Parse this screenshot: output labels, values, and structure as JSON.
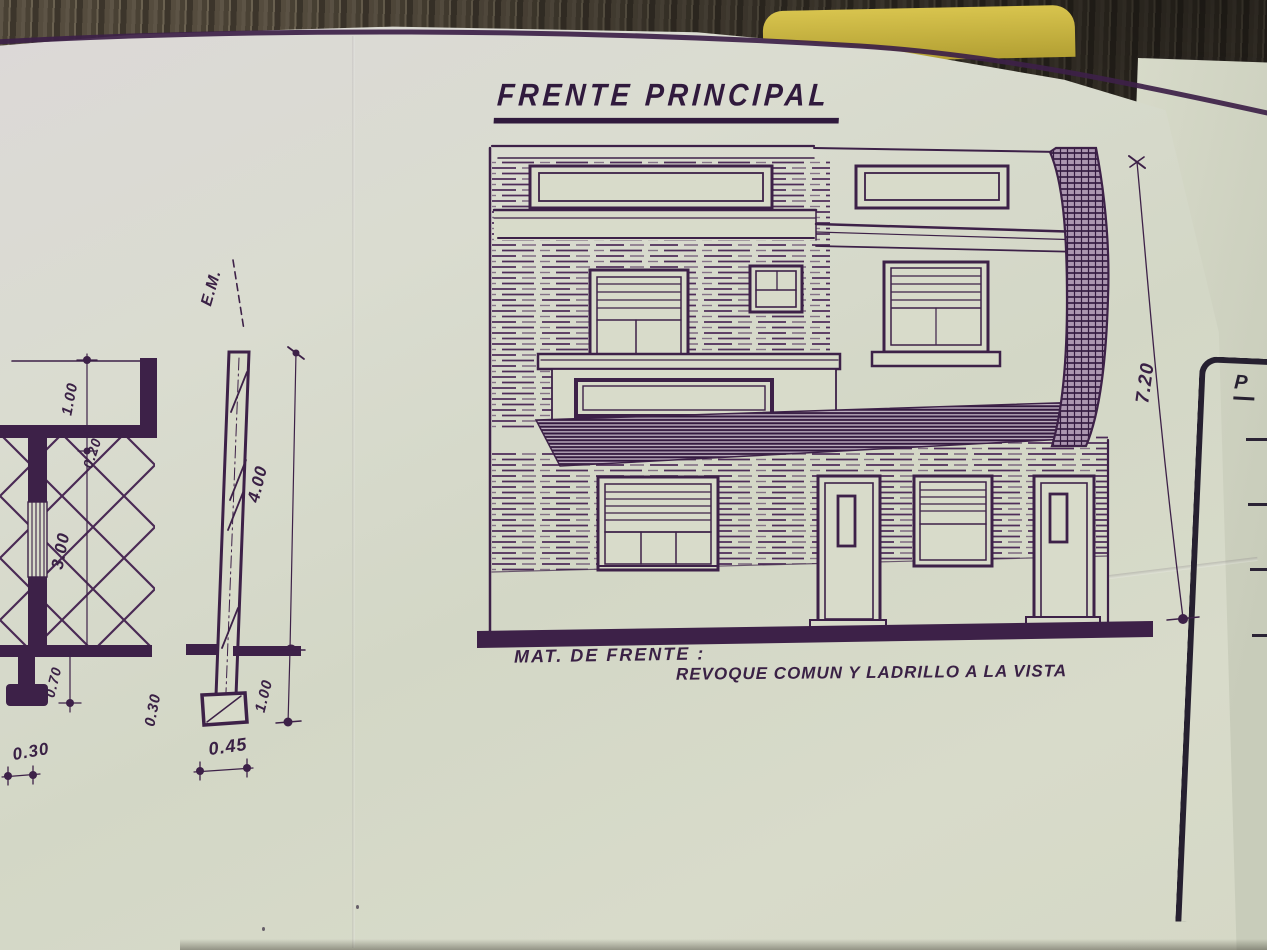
{
  "scene": {
    "description": "Photograph of an architectural blueprint sheet lying on a dark wooden table, second sheet and yellow note partially visible",
    "colors": {
      "ink": "#3d2148",
      "paper": "#d8dbca",
      "paper_right_sheet": "#cdd1bf",
      "wood_dark": "#3c352b",
      "wood_light": "#6a6150",
      "sticky_note": "#c9b540"
    }
  },
  "title": "FRENTE PRINCIPAL",
  "material_note": {
    "label": "MAT. DE FRENTE :",
    "value": "REVOQUE COMUN Y LADRILLO A LA VISTA"
  },
  "dimensions": {
    "elevation_total_height": "7.20",
    "section_axis": "E.M.",
    "section_upper": "4.00",
    "section_lower": "1.00",
    "section_footing_depth": "0.30",
    "section_footing_width": "0.45",
    "plan_opening": "1.00",
    "plan_wall_thickness": "0.20",
    "plan_room": "3.00",
    "plan_footing": "0.70",
    "plan_wall_width": "0.30"
  },
  "adjacent_sheet": {
    "partial_text": "P"
  }
}
